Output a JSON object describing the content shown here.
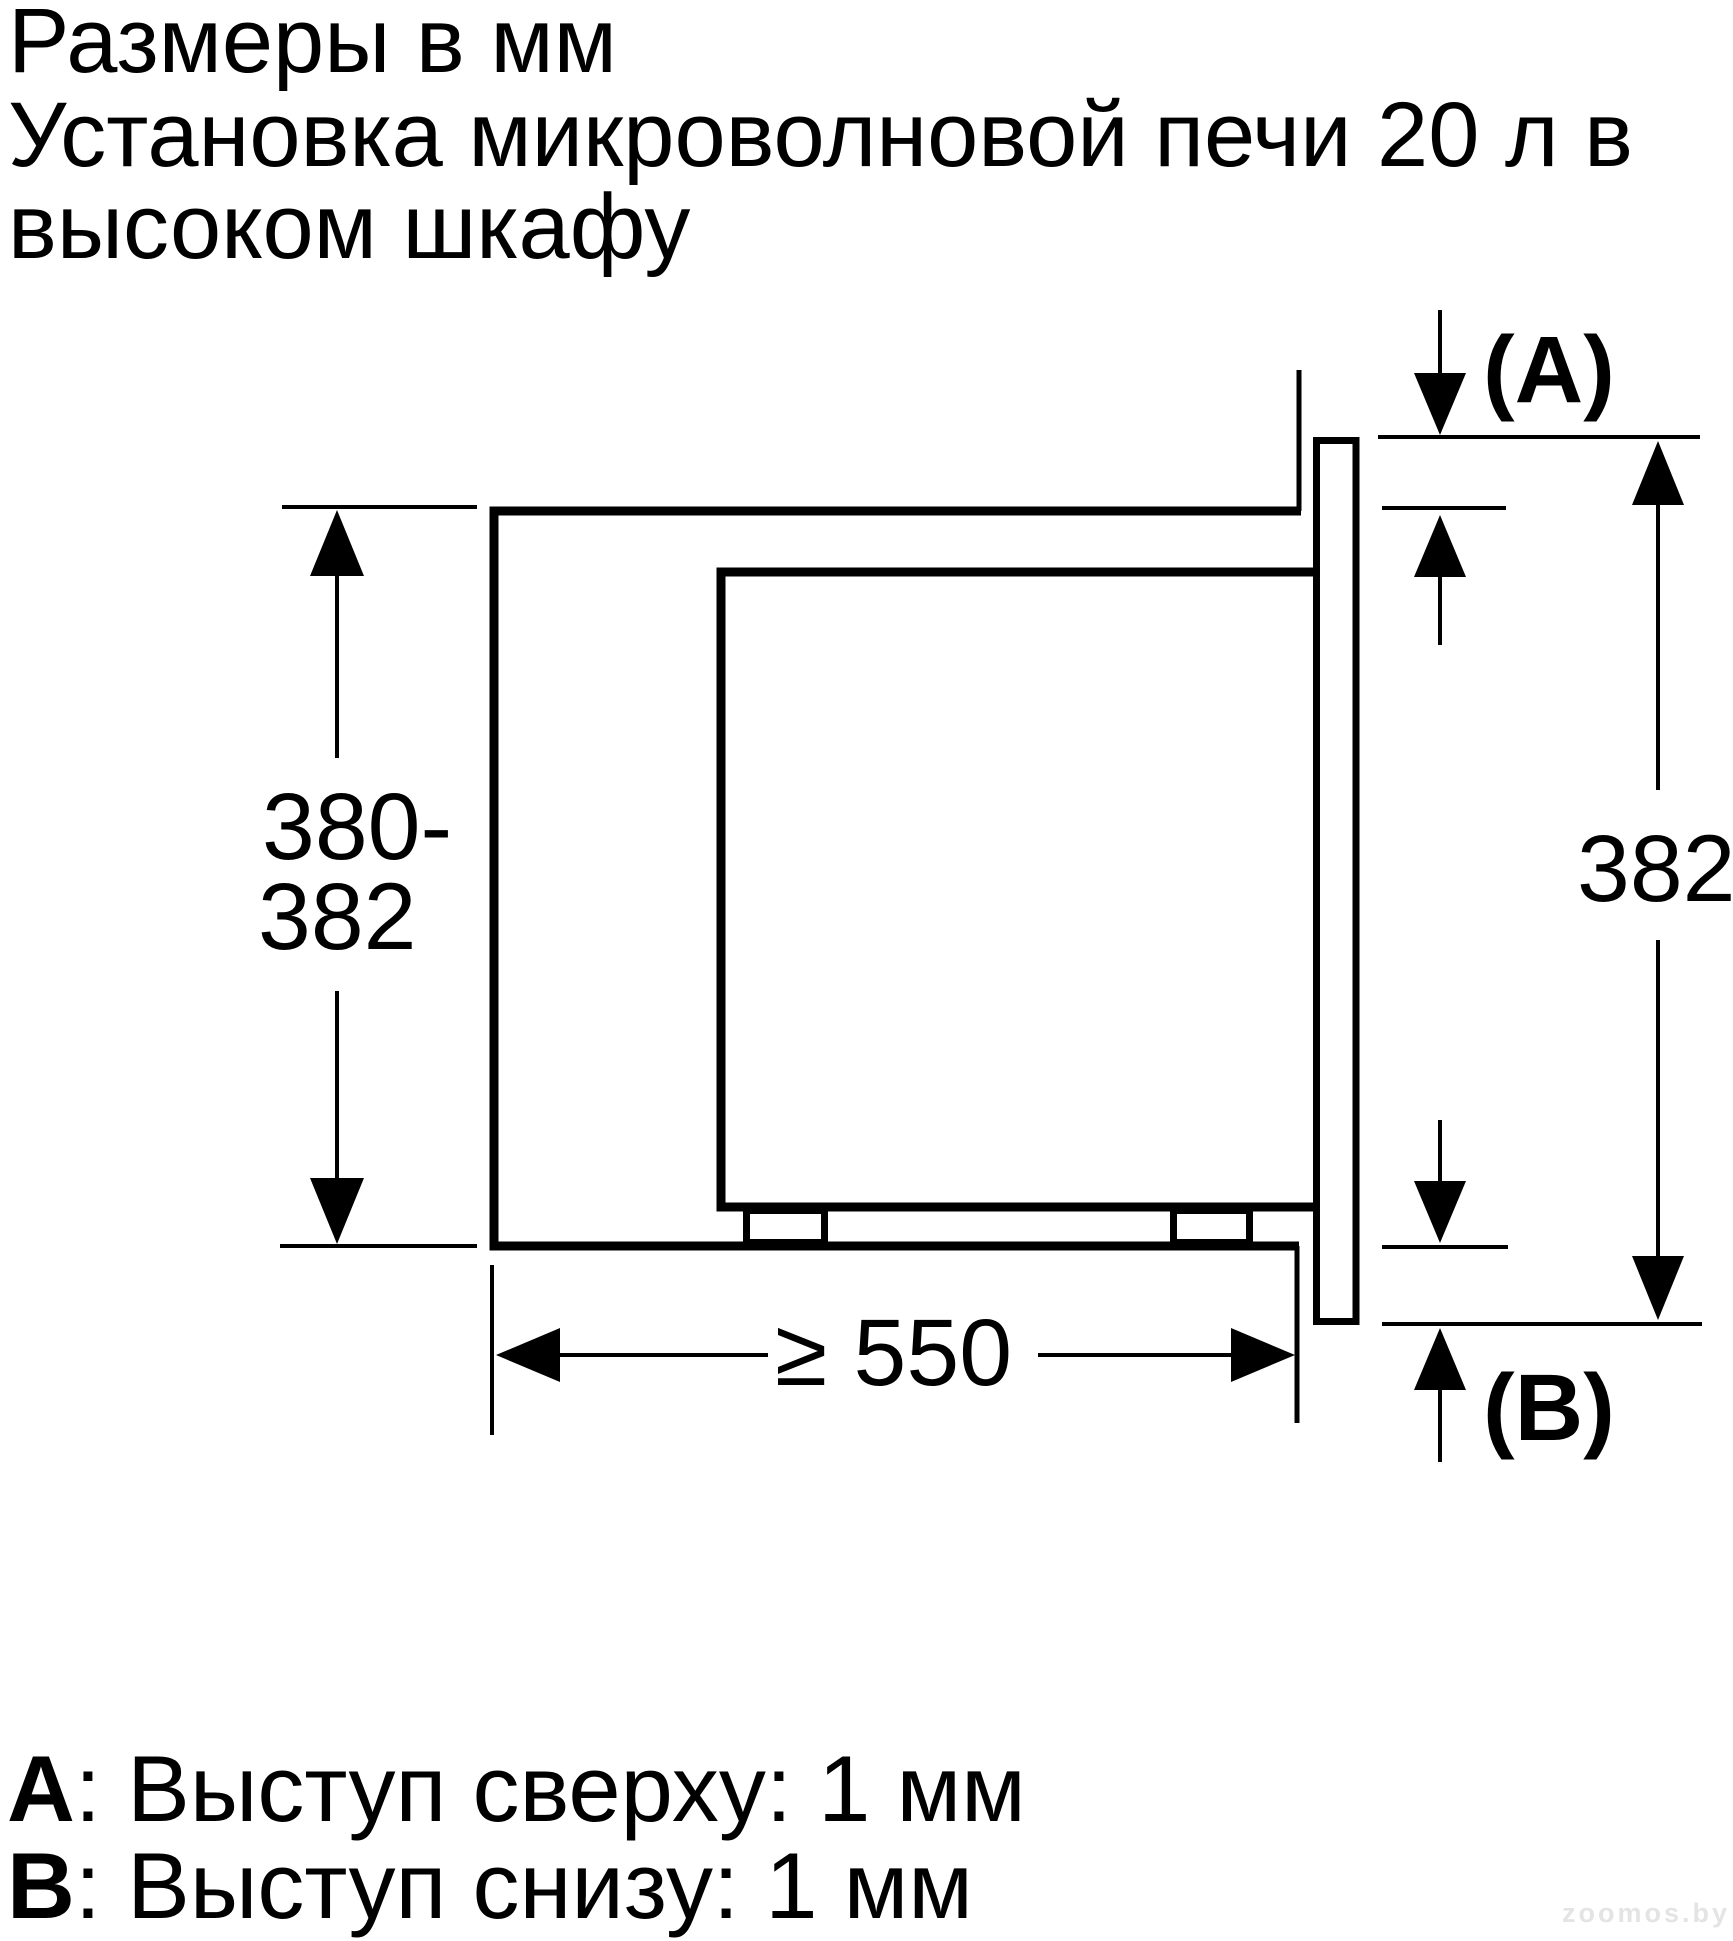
{
  "title": {
    "line1": "Размеры в мм",
    "line2": "Установка микроволновой печи 20 л в",
    "line3": "высоком шкафу"
  },
  "diagram": {
    "labels": {
      "niche_height_line1": "380-",
      "niche_height_line2": "382",
      "front_height": "382",
      "min_depth": "≥ 550",
      "overhang_top": "(A)",
      "overhang_bottom": "(B)"
    }
  },
  "notes": {
    "a_key": "A",
    "a_text": ": Выступ сверху: 1 мм",
    "b_key": "B",
    "b_text": ": Выступ снизу: 1 мм"
  },
  "watermark": "zoomos.by",
  "colors": {
    "ink": "#000000",
    "background": "#ffffff",
    "watermark": "#e4e4e4"
  }
}
